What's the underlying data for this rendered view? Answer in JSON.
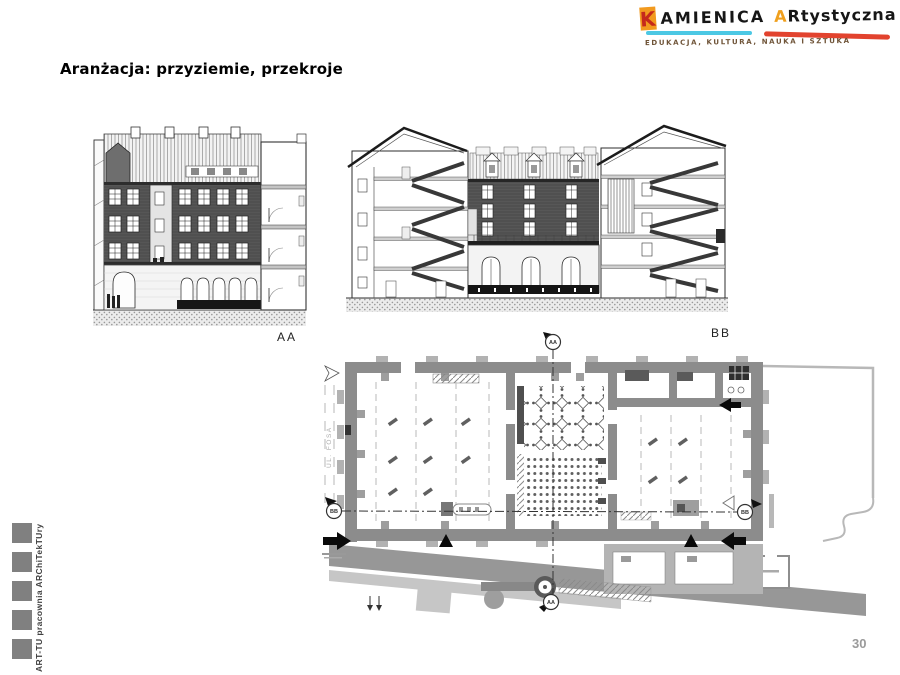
{
  "page": {
    "title": "Aranżacja: przyziemie, przekroje",
    "page_number": "30",
    "background": "#ffffff"
  },
  "logo": {
    "k_letter": "K",
    "word1_rest": "AMIENICA",
    "word2_first": "A",
    "word2_rest": "Rtystyczna",
    "subtitle": "EDUKACJA, KULTURA, NAUKA I SZTUKA",
    "colors": {
      "k_square": "#f29a1f",
      "k_letter": "#c5291c",
      "underline_1": "#4cc8e4",
      "underline_2": "#e2432e",
      "subtitle_text": "#6f5438"
    }
  },
  "sidebar": {
    "label": "ART-TU pracownia ARChiTekTUry",
    "square_count": 5,
    "square_color": "#808080"
  },
  "sections": {
    "aa_label": "AA",
    "bb_label": "BB"
  },
  "plan": {
    "marker_aa": "AA",
    "marker_bb": "BB",
    "street_label": "UL. FOSA"
  }
}
